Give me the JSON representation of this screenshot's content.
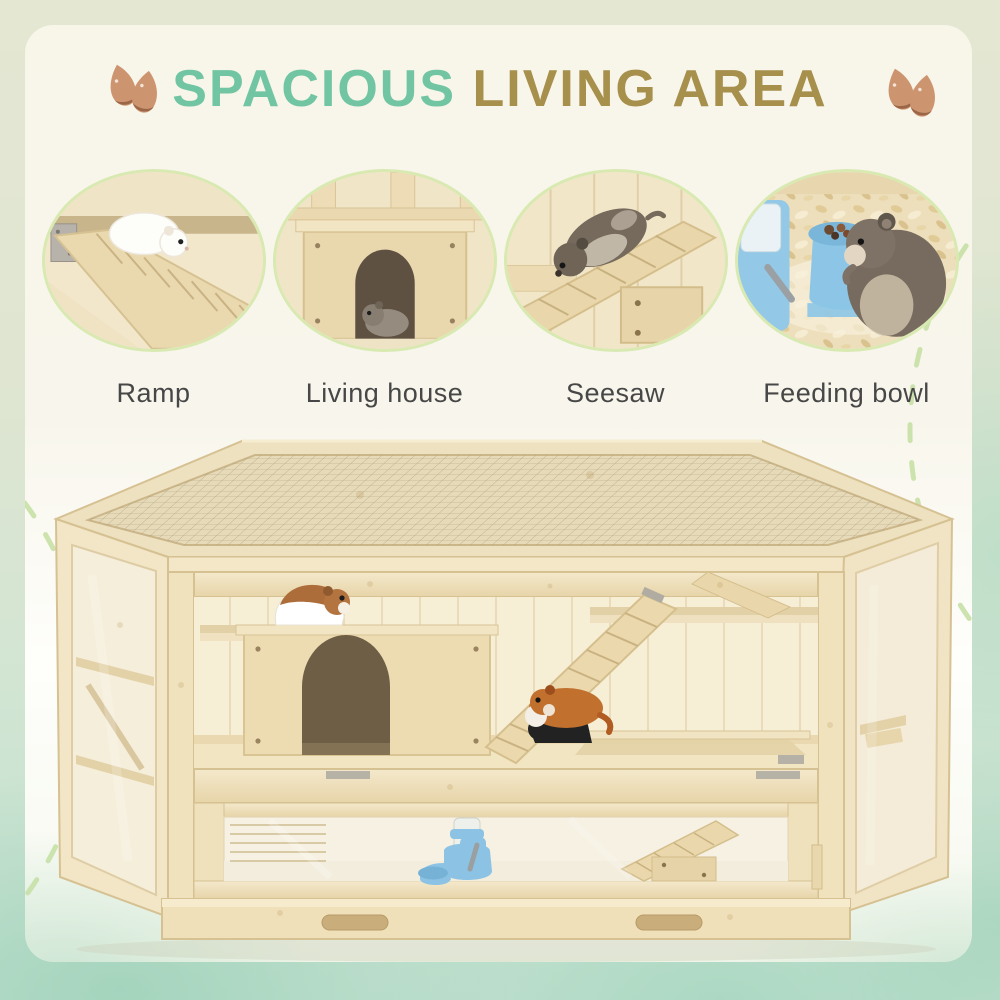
{
  "page": {
    "type": "product-feature-banner",
    "size": "1000x1000"
  },
  "header": {
    "title_parts": [
      {
        "text": "SPACIOUS",
        "color": "#72c5a2"
      },
      {
        "text": "LIVING AREA",
        "color": "#a6904c"
      }
    ],
    "decor_icons": [
      "seeds-icon",
      "seeds-icon"
    ]
  },
  "features": [
    {
      "label": "Ramp",
      "image_alt": "White hamster walking down a slatted wooden ramp"
    },
    {
      "label": "Living house",
      "image_alt": "Grey hamster inside a wooden house with an arched doorway under a platform"
    },
    {
      "label": "Seesaw",
      "image_alt": "Grey hamster climbing a wooden seesaw plank on a support block"
    },
    {
      "label": "Feeding bowl",
      "image_alt": "Grey hamster eating from a blue feeding bowl with water bottle on wood-shaving bedding"
    }
  ],
  "product": {
    "image_alt": "Natural fir wood hexagonal hamster cage with wire mesh top, clear acrylic side and front panels, multi-level platforms, arched living house, ramps, seesaw, blue water bottle with feeding bowl, cartoon hamsters, and a pull-out bottom tray with two handle cutouts"
  },
  "colors": {
    "title_teal": "#72c5a2",
    "title_gold": "#a6904c",
    "label_text": "#474747",
    "circle_border": "#d9e9b2",
    "dashed_decor": "#c6e0a6",
    "border_top": "#e4e7d2",
    "border_bottom": "#c2e1d0",
    "panel_cream": "#f8f5e9",
    "wood_light": "#f4e9cc",
    "wood_mid": "#e7d4a8",
    "mesh_wire": "#a99b79",
    "feeder_blue": "#8cc3e4",
    "seed_brown": "#cd9470"
  }
}
